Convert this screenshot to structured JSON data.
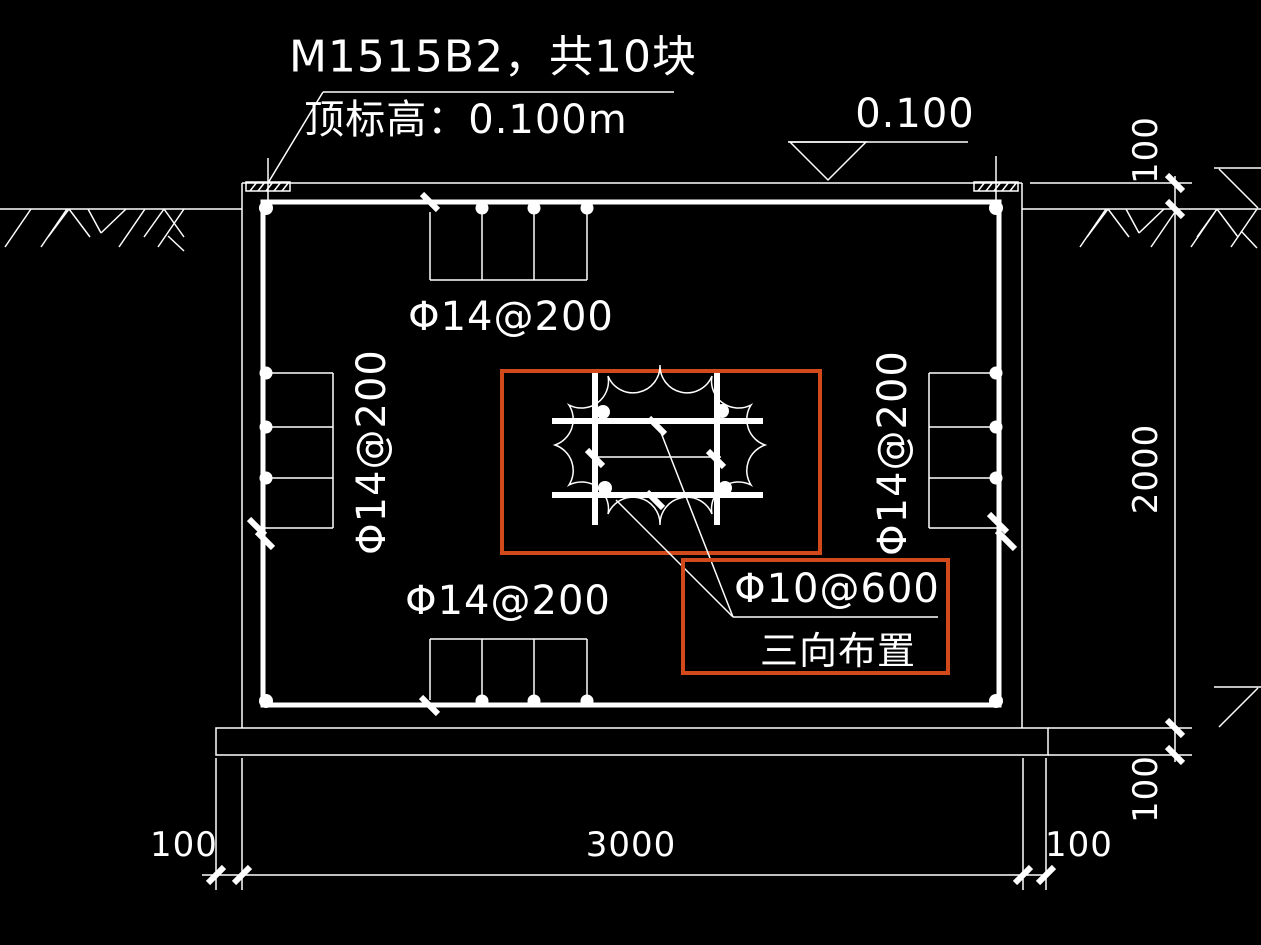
{
  "canvas": {
    "background_color": "#000000",
    "line_color": "#ffffff",
    "highlight_color": "#d2491c"
  },
  "leader_note": {
    "line1": "M1515B2，共10块",
    "line2": "顶标高：0.100m"
  },
  "elevation_marker": {
    "value": "0.100"
  },
  "rebar_labels": {
    "top": "Φ14@200",
    "bottom": "Φ14@200",
    "left": "Φ14@200",
    "right": "Φ14@200"
  },
  "callout": {
    "label": "Φ10@600",
    "note": "三向布置"
  },
  "dimensions": {
    "bottom": [
      {
        "label": "100"
      },
      {
        "label": "3000"
      },
      {
        "label": "100"
      }
    ],
    "right": [
      {
        "label": "100"
      },
      {
        "label": "2000"
      },
      {
        "label": "100"
      }
    ]
  }
}
